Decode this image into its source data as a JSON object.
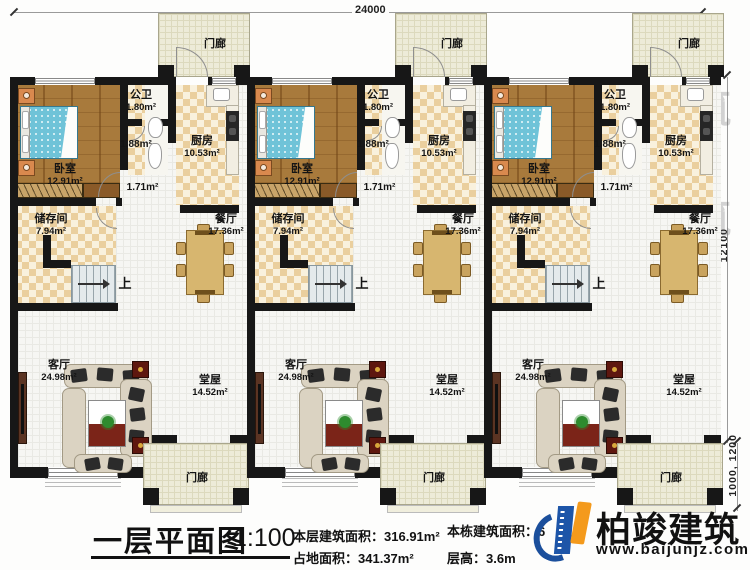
{
  "plan": {
    "dimensions": {
      "top": "24000",
      "right_main": "12100",
      "right_porch": "1000, 1200"
    },
    "rooms": {
      "porch": {
        "label": "门廊"
      },
      "bedroom": {
        "label": "卧室",
        "area": "12.91m²"
      },
      "bathroom": {
        "label": "公卫",
        "area": "1.80m²"
      },
      "wash_area": {
        "area": "1.88m²"
      },
      "hallway": {
        "area": "1.71m²"
      },
      "kitchen": {
        "label": "厨房",
        "area": "10.53m²"
      },
      "storage": {
        "label": "储存间",
        "area": "7.94m²"
      },
      "dining": {
        "label": "餐厅",
        "area": "17.36m²"
      },
      "living": {
        "label": "客厅",
        "area": "24.98m²"
      },
      "main_hall": {
        "label": "堂屋",
        "area": "14.52m²"
      },
      "stairs": {
        "up": "上"
      }
    }
  },
  "footer": {
    "title": "一层平面图",
    "scale": "1:100",
    "stats": {
      "floor_area_label": "本层建筑面积：",
      "floor_area_value": "316.91m²",
      "land_area_label": "占地面积：",
      "land_area_value": "341.37m²",
      "building_area_label": "本栋建筑面积：",
      "building_area_value": "6",
      "floor_height_label": "层高：",
      "floor_height_value": "3.6m"
    }
  },
  "brand": {
    "name": "柏竣建筑",
    "website": "www.baijunjz.com"
  },
  "watermark": {
    "name": "柏竣建筑",
    "website": "www.baijunjz.com"
  }
}
